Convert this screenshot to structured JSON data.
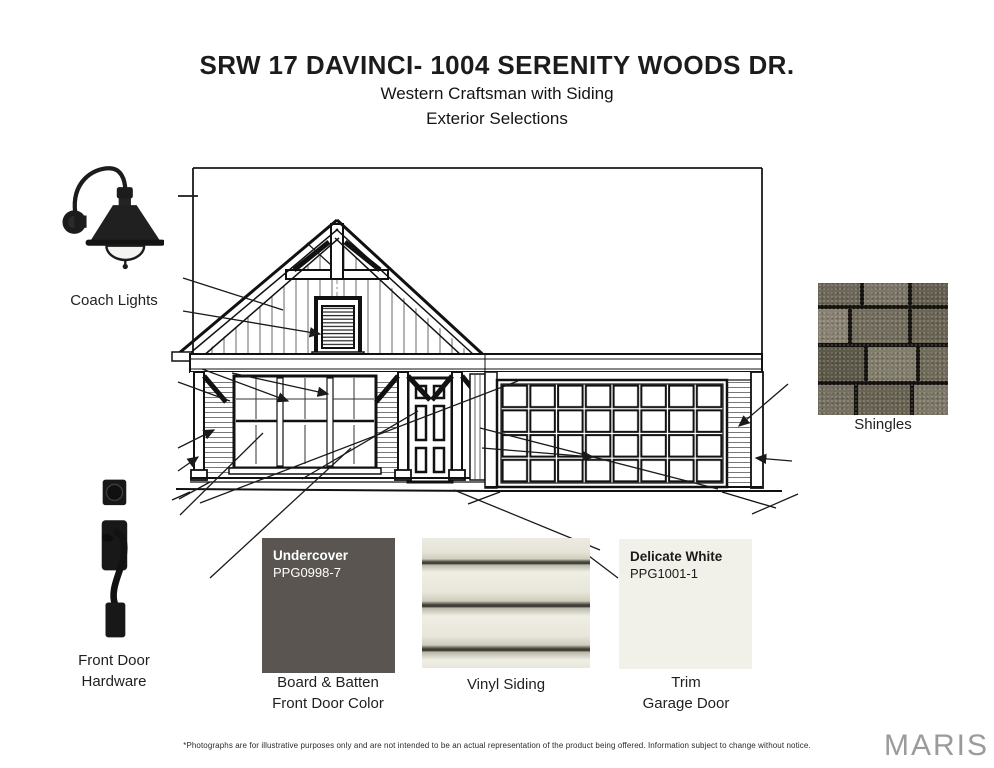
{
  "header": {
    "title": "SRW 17 DAVINCI- 1004 SERENITY WOODS DR.",
    "subtitle": "Western Craftsman with Siding",
    "subtitle2": "Exterior Selections"
  },
  "selections": {
    "coach_lights_label": "Coach Lights",
    "shingles_label": "Shingles",
    "front_door_hardware_label_line1": "Front Door",
    "front_door_hardware_label_line2": "Hardware",
    "board_batten_swatch": {
      "name": "Undercover",
      "code": "PPG0998-7",
      "color": "#5a5550",
      "text_color": "#ffffff",
      "caption_line1": "Board & Batten",
      "caption_line2": "Front Door Color"
    },
    "vinyl_siding_swatch": {
      "caption": "Vinyl Siding",
      "base_color": "#eae8dc"
    },
    "trim_swatch": {
      "name": "Delicate White",
      "code": "PPG1001-1",
      "color": "#f1f1ea",
      "text_color": "#1a1a1a",
      "caption_line1": "Trim",
      "caption_line2": "Garage Door"
    }
  },
  "footer": {
    "disclaimer": "*Photographs are for illustrative purposes only and are not intended to be an actual representation of the product being offered. Information subject to change without notice.",
    "watermark": "MARIS",
    "watermark_color": "#9b9b9b"
  }
}
